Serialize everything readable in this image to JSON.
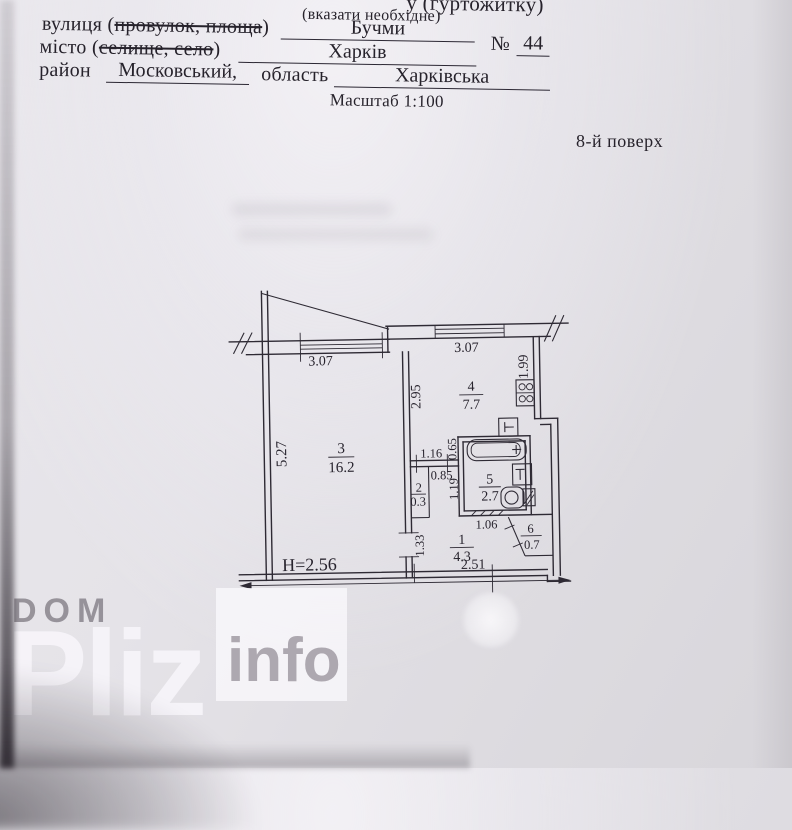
{
  "header": {
    "top_partial": "у (гуртожитку)",
    "note": "(вказати необхідне)",
    "street": {
      "prefix": "вулиця (",
      "struck": "провулок, площа",
      "suffix": ")",
      "value": "Бучми"
    },
    "number": {
      "sign": "№",
      "value": "44"
    },
    "city": {
      "prefix": "місто (",
      "struck": "селище, село",
      "suffix": ")",
      "value": "Харків"
    },
    "district": {
      "label": "район",
      "value": "Московський,"
    },
    "region": {
      "label": "область",
      "value": "Харківська"
    },
    "scale_note": "Масштаб 1:100",
    "floor_label": "8-й поверх"
  },
  "plan": {
    "height_note": "H=2.56",
    "dims": {
      "window_left": "3.07",
      "window_right": "3.07",
      "kitchen_depth": "1.99",
      "kitchen_width": "2.95",
      "room_depth": "5.27",
      "pass_depth": "0.65",
      "pass_width": "1.16",
      "door_width": "0.85",
      "bath_depth": "1.19",
      "bath_width": "1.06",
      "hall_door": "1.33",
      "hall_width": "2.51"
    },
    "rooms": {
      "living": {
        "num": "3",
        "area": "16.2"
      },
      "kitchen": {
        "num": "4",
        "area": "7.7"
      },
      "bath": {
        "num": "5",
        "area": "2.7"
      },
      "closet": {
        "num": "2",
        "area": "0.3"
      },
      "hall": {
        "num": "1",
        "area": "4.3"
      },
      "builtin": {
        "num": "6",
        "area": "0.7"
      }
    }
  },
  "watermark": {
    "dom": "DOM",
    "pliz": "Pliz",
    "info": "info"
  },
  "colors": {
    "paper": "#e4e2e7",
    "ink": "#27232d",
    "watermark_light": "#f8f6fa",
    "watermark_gray": "#9b959e"
  }
}
